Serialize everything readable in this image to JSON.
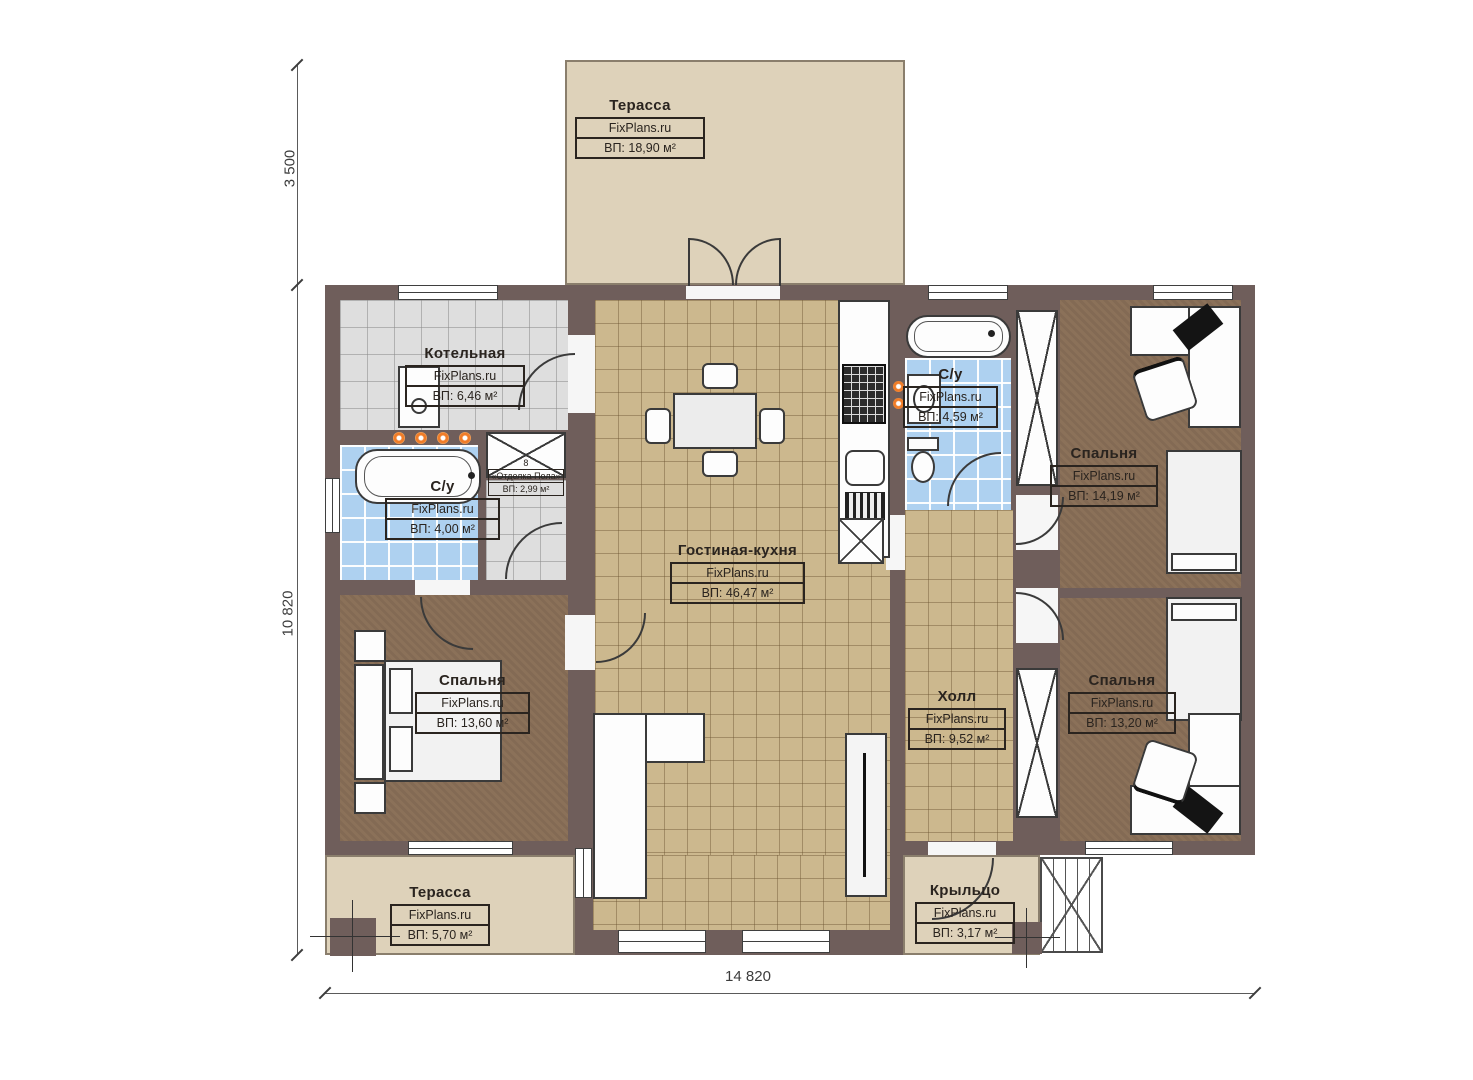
{
  "site": "FixPlans.ru",
  "dims": {
    "v_top": "3 500",
    "v_left": "10 820",
    "h_bottom": "14 820"
  },
  "rooms": {
    "terrace_top": {
      "name": "Терасса",
      "brand": "FixPlans.ru",
      "area": "ВП: 18,90 м²"
    },
    "boiler": {
      "name": "Котельная",
      "brand": "FixPlans.ru",
      "area": "ВП: 6,46 м²"
    },
    "bath_left": {
      "name": "С/у",
      "brand": "FixPlans.ru",
      "area": "ВП: 4,00 м²"
    },
    "storage": {
      "note": "8",
      "name": "«Отделка Пола»",
      "area": "ВП: 2,99 м²"
    },
    "bedroom_left": {
      "name": "Спальня",
      "brand": "FixPlans.ru",
      "area": "ВП: 13,60 м²"
    },
    "living": {
      "name": "Гостиная-кухня",
      "brand": "FixPlans.ru",
      "area": "ВП: 46,47 м²"
    },
    "bath_right": {
      "name": "С/у",
      "brand": "FixPlans.ru",
      "area": "ВП: 4,59 м²"
    },
    "hall": {
      "name": "Холл",
      "brand": "FixPlans.ru",
      "area": "ВП: 9,52 м²"
    },
    "bedroom_top_right": {
      "name": "Спальня",
      "brand": "FixPlans.ru",
      "area": "ВП: 14,19 м²"
    },
    "bedroom_bottom_right": {
      "name": "Спальня",
      "brand": "FixPlans.ru",
      "area": "ВП: 13,20 м²"
    },
    "terrace_bottom": {
      "name": "Терасса",
      "brand": "FixPlans.ru",
      "area": "ВП: 5,70 м²"
    },
    "porch": {
      "name": "Крыльцо",
      "brand": "FixPlans.ru",
      "area": "ВП: 3,17 м²"
    }
  },
  "colors": {
    "wall": "#6f5e5b",
    "floor_tan": "#ccb88e",
    "floor_blue": "#aed1f0",
    "floor_gray": "#dedede",
    "carpet": "#8b7159",
    "terrace": "#ded2ba",
    "accent_dot": "#f07c28"
  }
}
